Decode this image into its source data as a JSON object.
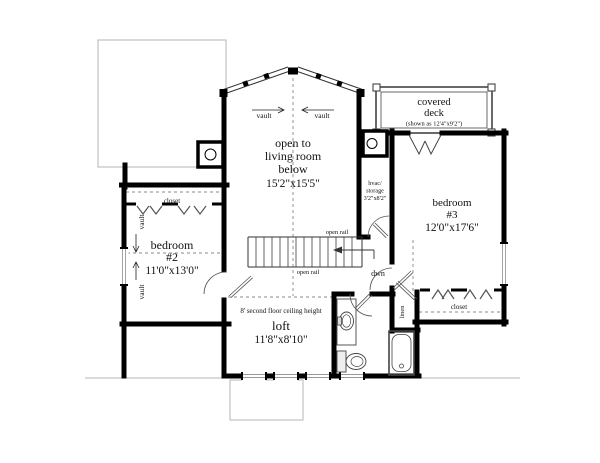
{
  "rooms": {
    "open_to_living_room": {
      "line1": "open to",
      "line2": "living room",
      "line3": "below",
      "dims": "15'2\"x15'5\""
    },
    "covered_deck": {
      "line1": "covered",
      "line2": "deck",
      "note": "(shown as 12'4\"x9'2\")"
    },
    "bedroom_3": {
      "line1": "bedroom",
      "line2": "#3",
      "dims": "12'0\"x17'6\""
    },
    "bedroom_2": {
      "line1": "bedroom",
      "line2": "#2",
      "dims": "11'0\"x13'0\""
    },
    "loft": {
      "ceiling_note": "8' second floor ceiling height",
      "name": "loft",
      "dims": "11'8\"x8'10\""
    },
    "hvac_storage": {
      "line1": "hvac/",
      "line2": "storage",
      "dims": "3'2\"x8'2\""
    }
  },
  "annotations": {
    "vault": "vault",
    "open_rail": "open rail",
    "down": "dwn",
    "closet": "closet",
    "linen": "linen"
  },
  "colors": {
    "wall": "#000000",
    "roof_outline": "#b5b5b5",
    "dashed": "#888888",
    "hanger": "#555555"
  }
}
